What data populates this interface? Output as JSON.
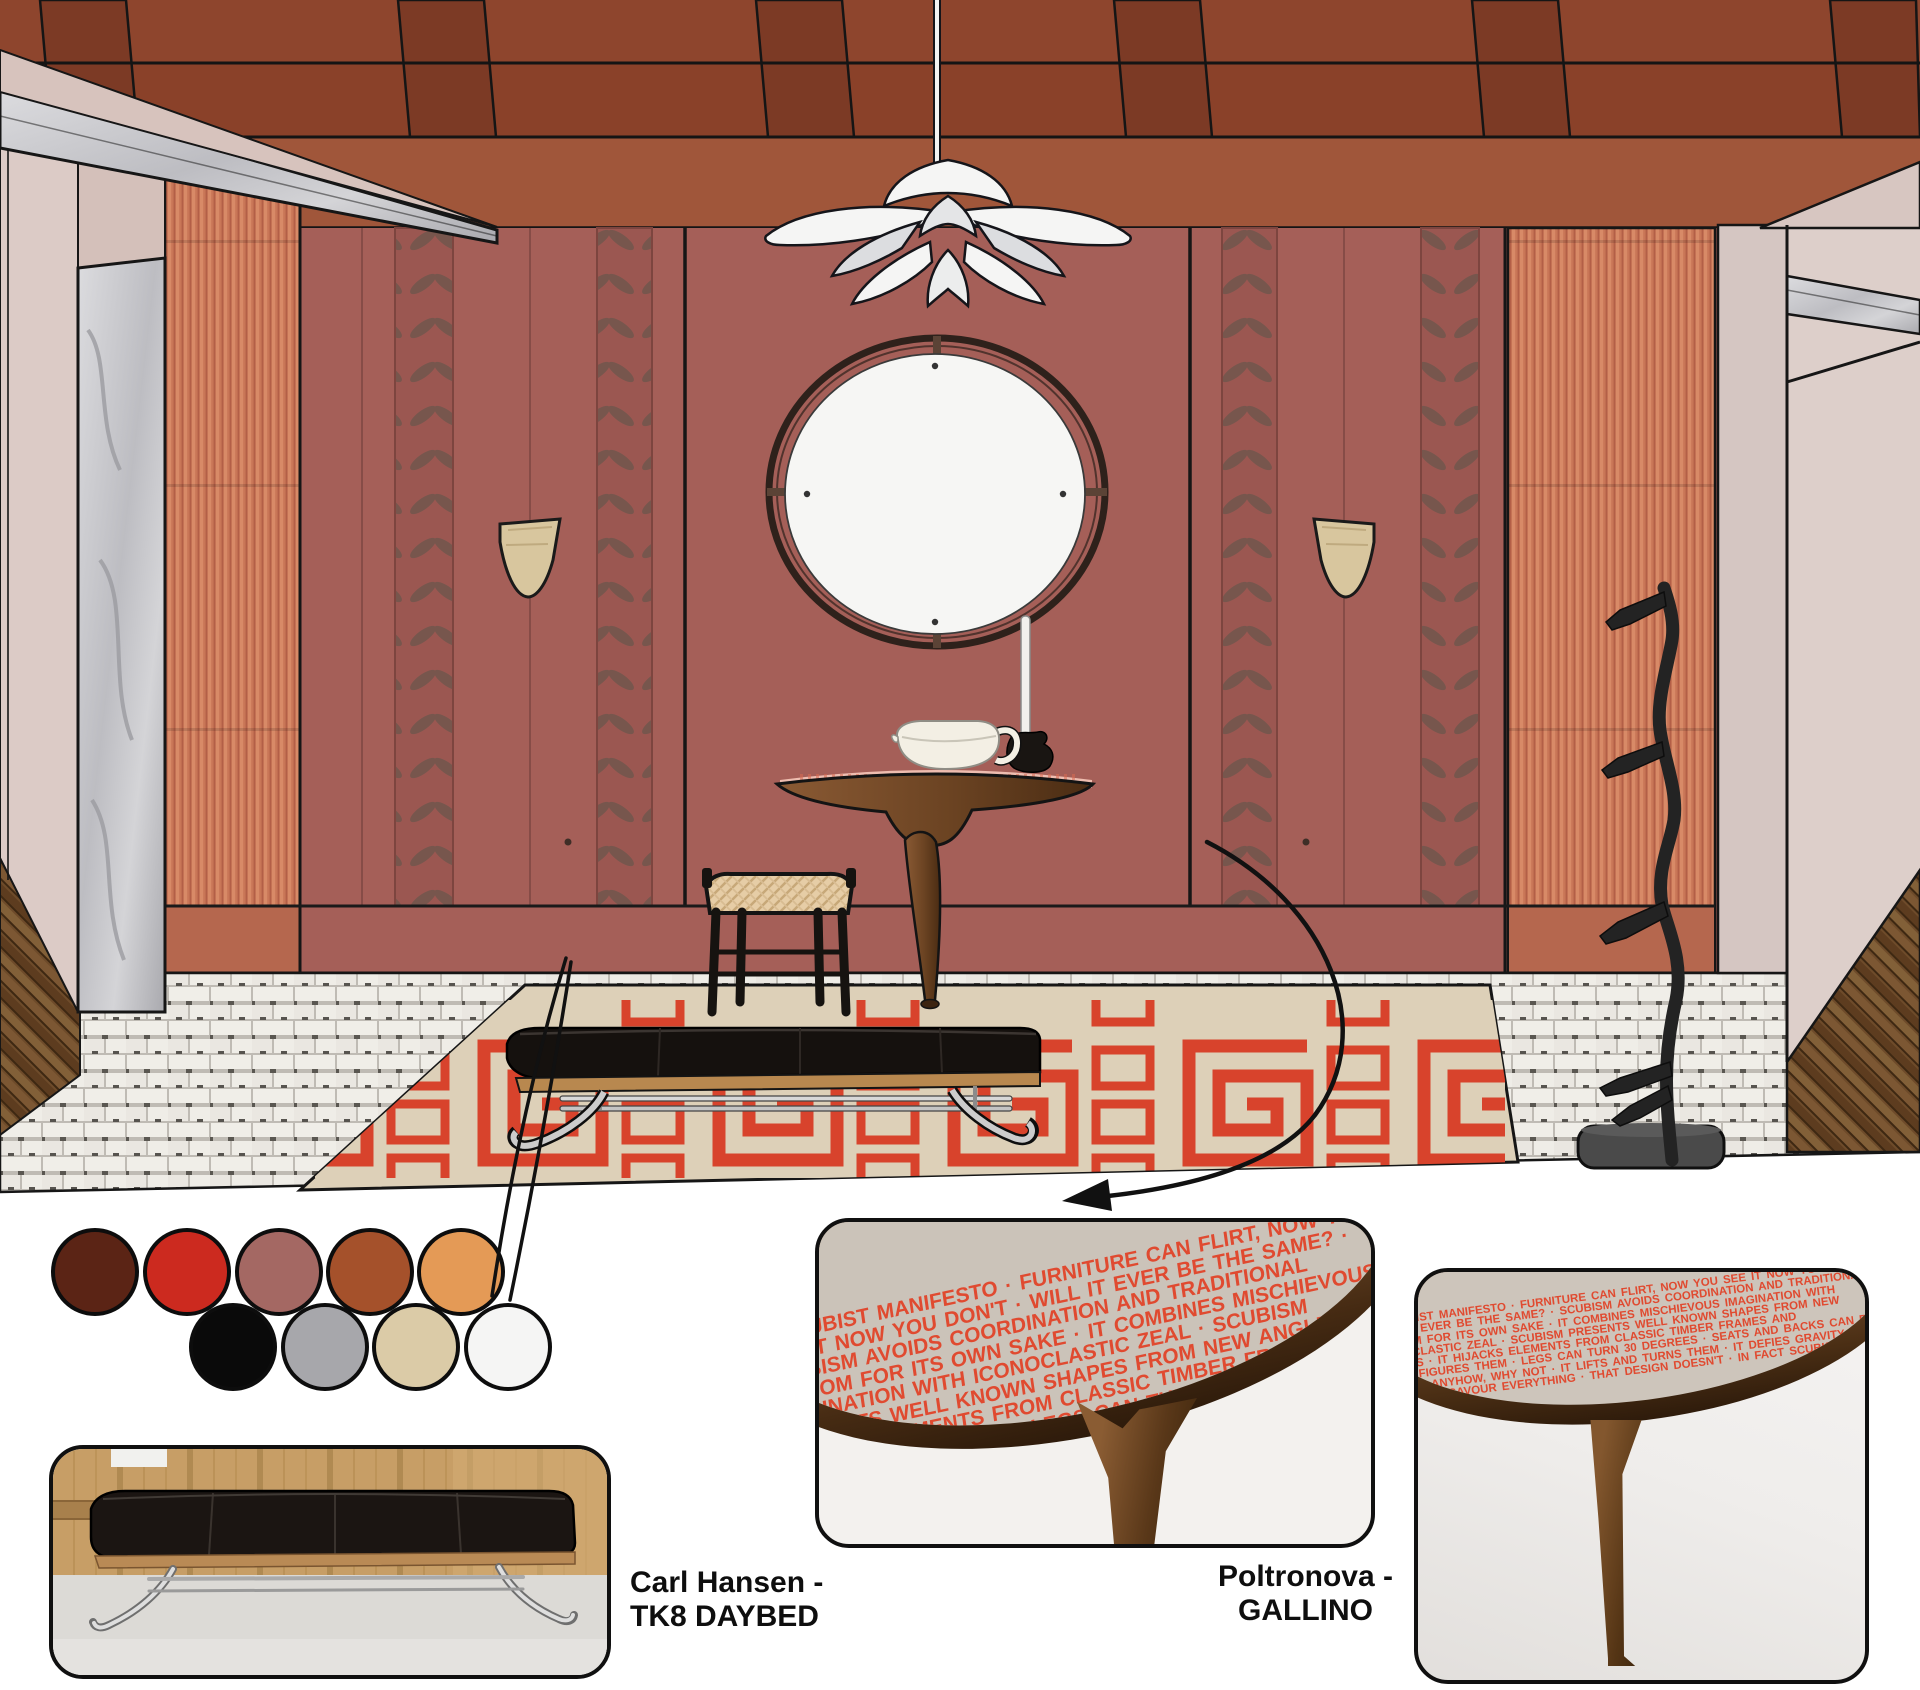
{
  "annotations": {
    "daybed": {
      "line1": "Carl Hansen -",
      "line2": "TK8  DAYBED"
    },
    "console": {
      "line1": "Poltronova -",
      "line2": "GALLINO"
    }
  },
  "palette": {
    "swatches": [
      {
        "name": "dark-maroon",
        "hex": "#5B2415"
      },
      {
        "name": "red",
        "hex": "#CC2A1F"
      },
      {
        "name": "dusty-mauve",
        "hex": "#A46863"
      },
      {
        "name": "rust",
        "hex": "#A5512B"
      },
      {
        "name": "ochre-orange",
        "hex": "#E49A56"
      },
      {
        "name": "black",
        "hex": "#0A0A0A"
      },
      {
        "name": "grey",
        "hex": "#A7A7AB"
      },
      {
        "name": "sand",
        "hex": "#DBCBA7"
      },
      {
        "name": "white",
        "hex": "#F5F5F4"
      }
    ]
  },
  "scene_colors": {
    "wall_marsala": "#A55F58",
    "ribbed_coral": "#CC7A5F",
    "ceiling_brick": "#9A4C31",
    "rug_red": "#D8432C",
    "rug_cream": "#DDD0B8",
    "floor_tile": "#ECE9E4",
    "marble": "#C9C9CC",
    "wood": "#6F4827"
  },
  "manifesto_text": "A SCUBIST MANIFESTO · FURNITURE CAN FLIRT, NOW YOU SEE IT NOW YOU DON'T · WILL IT EVER BE THE SAME? · SCUBISM AVOIDS COORDINATION AND TRADITIONAL WISDOM FOR ITS OWN SAKE · IT COMBINES MISCHIEVOUS IMAGINATION WITH ICONOCLASTIC ZEAL · SCUBISM PRESENTS WELL KNOWN SHAPES FROM NEW ANGLES · IT HIJACKS ELEMENTS FROM CLASSIC TIMBER FRAMES AND RECONFIGURES THEM · LEGS CAN TURN 30 DEGREES · SEATS AND BACKS CAN BE TURNED ANYHOW, WHY NOT · IT LIFTS AND TURNS THEM · IT DEFIES GRAVITY · IT'LL MAKE YOU SAVOUR EVERYTHING · THAT DESIGN DOESN'T · IN FACT SCUBISM IS A RELIGION"
}
